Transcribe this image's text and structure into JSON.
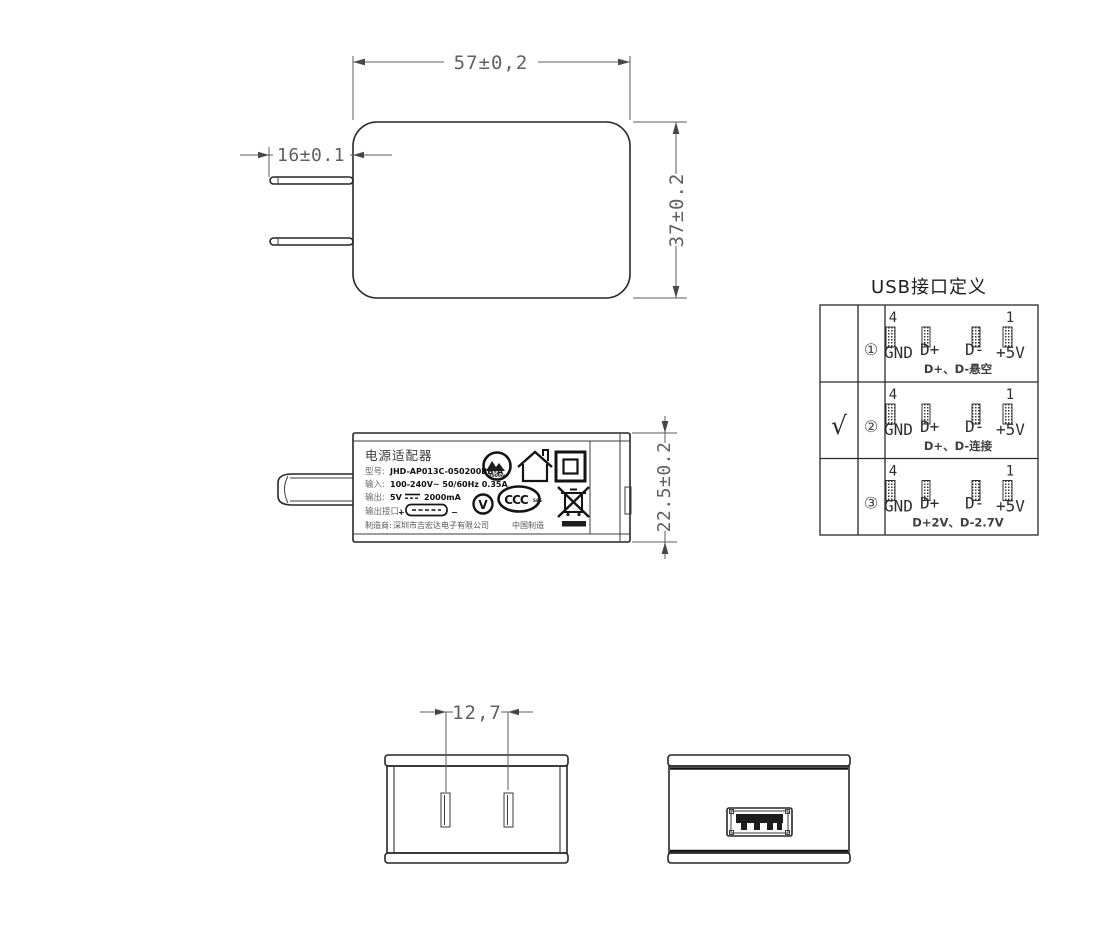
{
  "front_view": {
    "dim_width": "57±0,2",
    "dim_height": "37±0.2",
    "dim_pin_length": "16±0.1"
  },
  "side_view": {
    "dim_thickness": "22.5±0.2",
    "label": {
      "title": "电源适配器",
      "model_label": "型号:",
      "model": "JHD-AP013C-050200BB-A",
      "input_label": "输入:",
      "input": "100-240V~  50/60Hz  0.35A",
      "output_label": "输出:",
      "output_voltage": "5V",
      "output_current": "2000mA",
      "port_label": "输出接口:",
      "plus": "+",
      "minus": "−",
      "mfr_label": "制造商:",
      "mfr": "深圳市吉宏达电子有限公司",
      "made_in": "中国制造",
      "altitude_icon_text": "2000m",
      "efficiency_icon_text": "V",
      "ccc_icon_text": "CCC",
      "ccc_icon_sub": "S&E"
    }
  },
  "usb_table": {
    "title": "USB接口定义",
    "pin_num_left": "4",
    "pin_num_right": "1",
    "pins": [
      "GND",
      "D+",
      "D-",
      "+5V"
    ],
    "rows": [
      {
        "check": "",
        "index": "①",
        "note": "D+、D-悬空"
      },
      {
        "check": "√",
        "index": "②",
        "note": "D+、D-连接"
      },
      {
        "check": "",
        "index": "③",
        "note": "D+2V、D-2.7V"
      }
    ]
  },
  "bottom_view": {
    "dim_pin_pitch": "12,7"
  }
}
